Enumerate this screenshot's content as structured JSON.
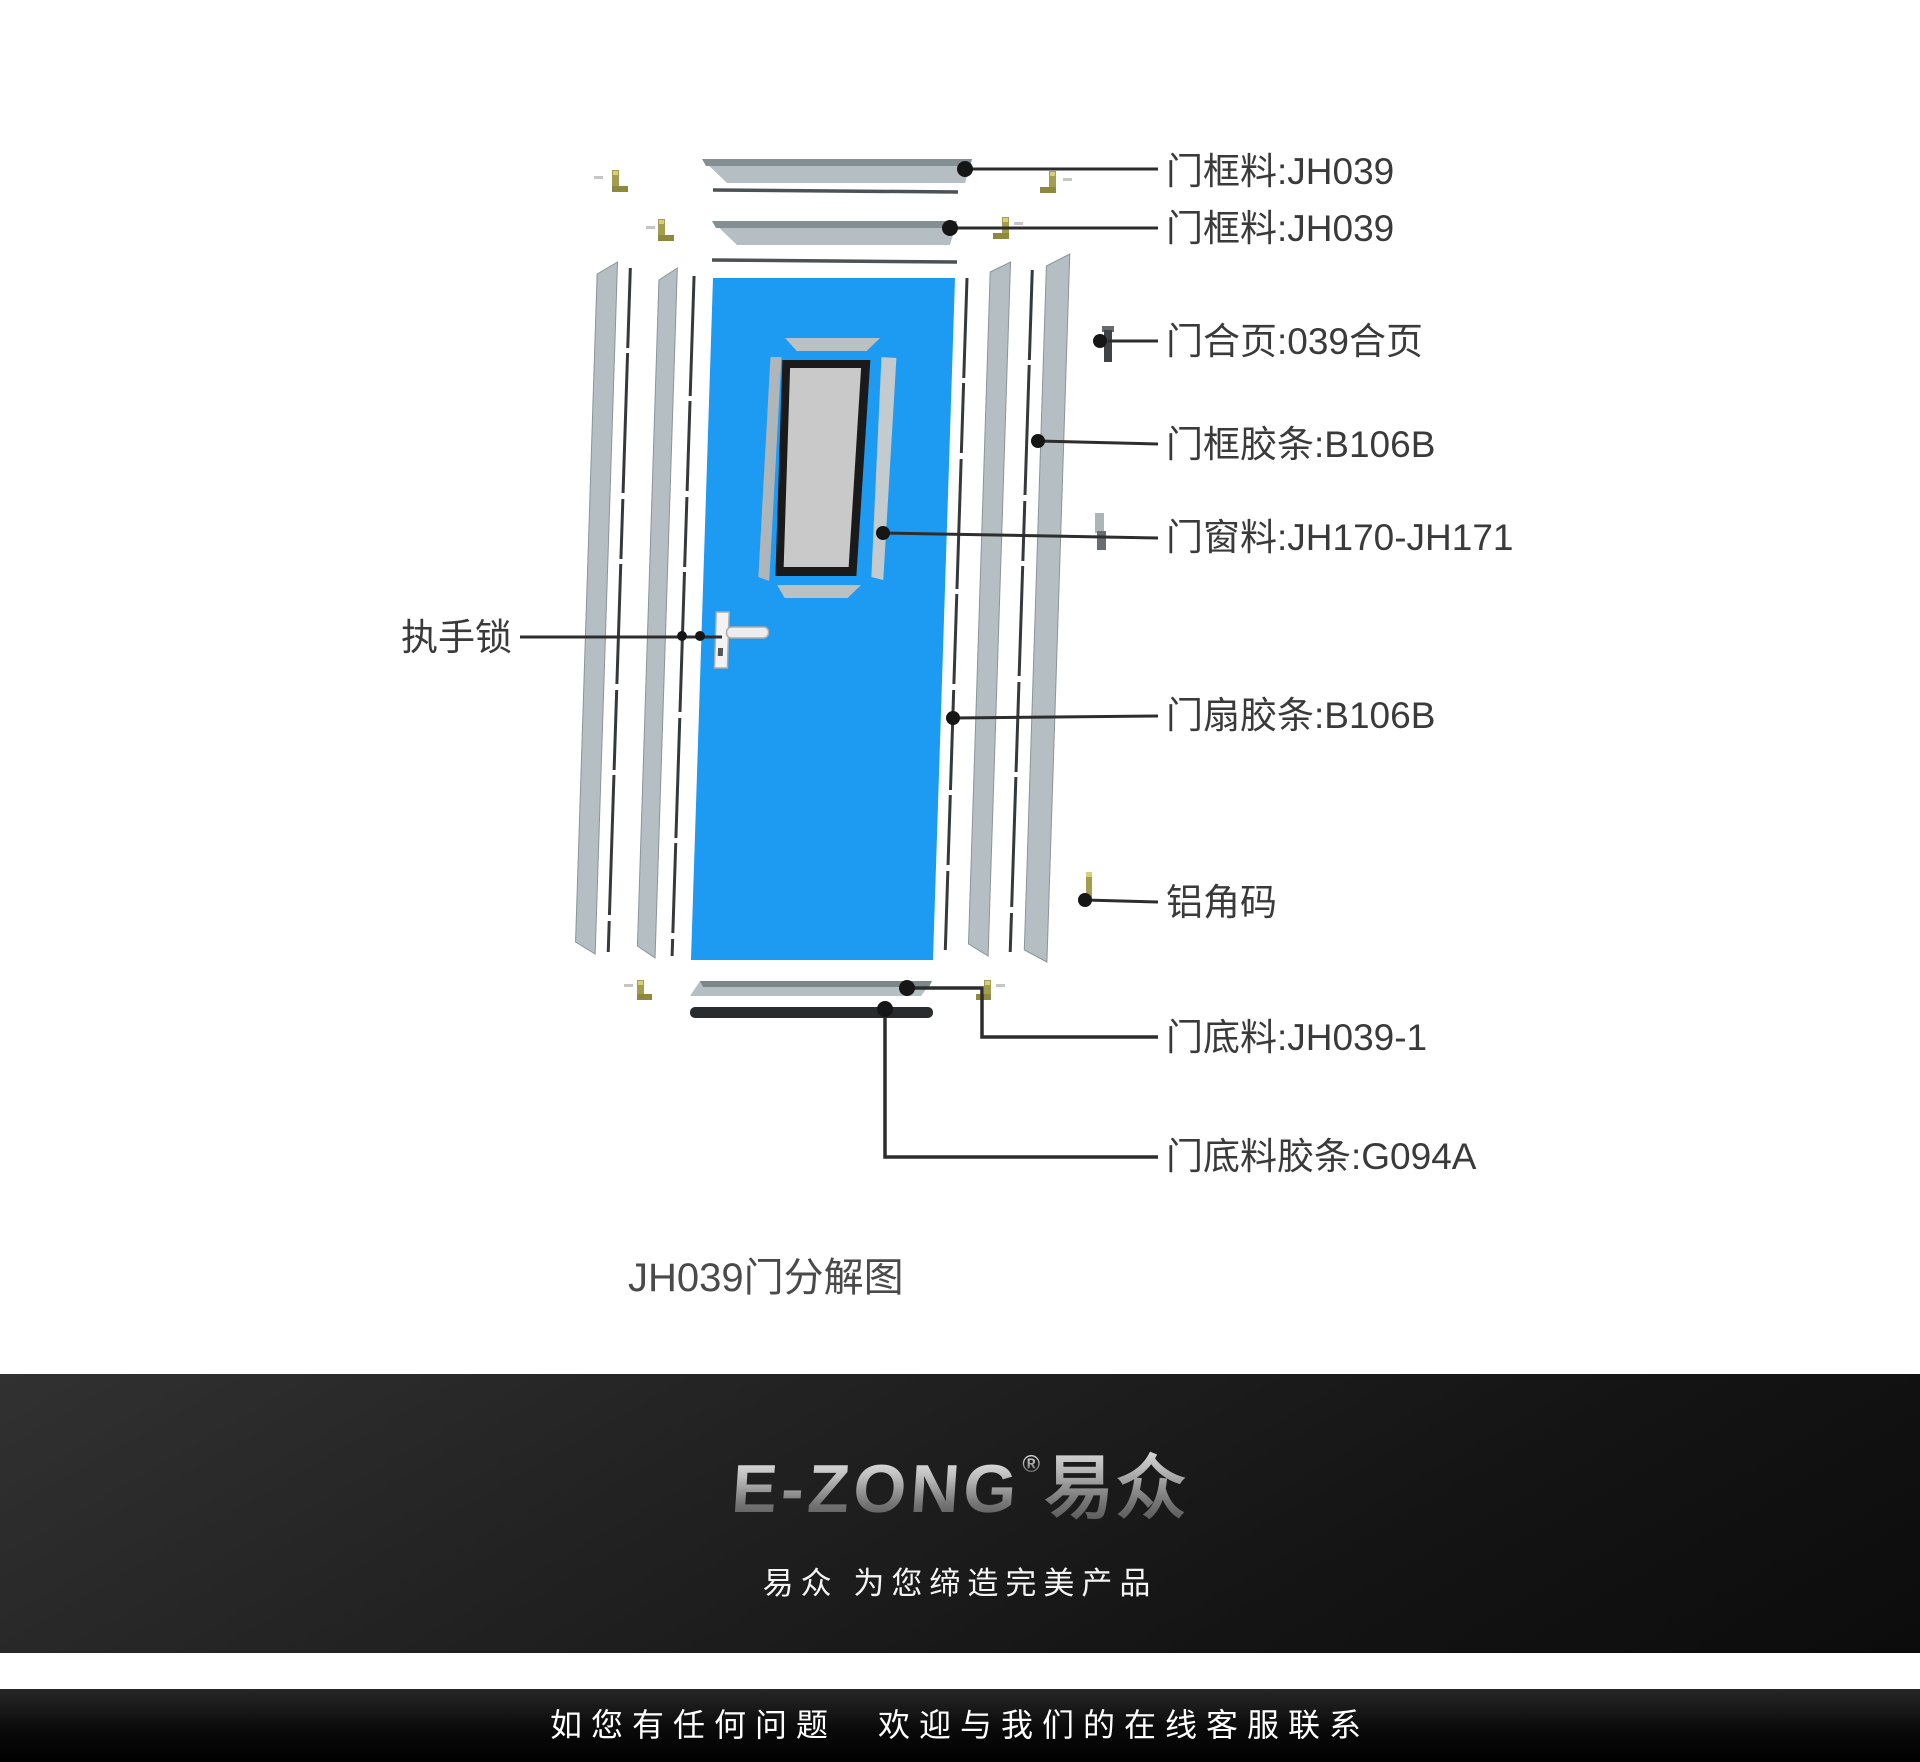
{
  "diagram": {
    "caption": "JH039门分解图",
    "labels": [
      {
        "id": "frame-rail-1",
        "text": "门框料:JH039"
      },
      {
        "id": "frame-rail-2",
        "text": "门框料:JH039"
      },
      {
        "id": "hinge",
        "text": "门合页:039合页"
      },
      {
        "id": "frame-gasket",
        "text": "门框胶条:B106B"
      },
      {
        "id": "window-profile",
        "text": "门窗料:JH170-JH171"
      },
      {
        "id": "handle-lock",
        "text": "执手锁"
      },
      {
        "id": "leaf-gasket",
        "text": "门扇胶条:B106B"
      },
      {
        "id": "aluminum-corner",
        "text": "铝角码"
      },
      {
        "id": "bottom-rail",
        "text": "门底料:JH039-1"
      },
      {
        "id": "bottom-gasket",
        "text": "门底料胶条:G094A"
      }
    ],
    "colors": {
      "door_blue": "#1d9af1",
      "aluminium_grey": "#b5bec2",
      "gasket_dark": "#35393c",
      "leader_line": "#2d2d2d",
      "label_text": "#3a3a3a",
      "bracket_olive": "#a59d4e",
      "glass_grey": "#c9c9c9"
    }
  },
  "footer": {
    "logo": {
      "latin": "E-ZONG",
      "reg": "®",
      "cjk": "易众"
    },
    "tagline": "易众 为您缔造完美产品",
    "service_text": "如您有任何问题　欢迎与我们的在线客服联系"
  }
}
